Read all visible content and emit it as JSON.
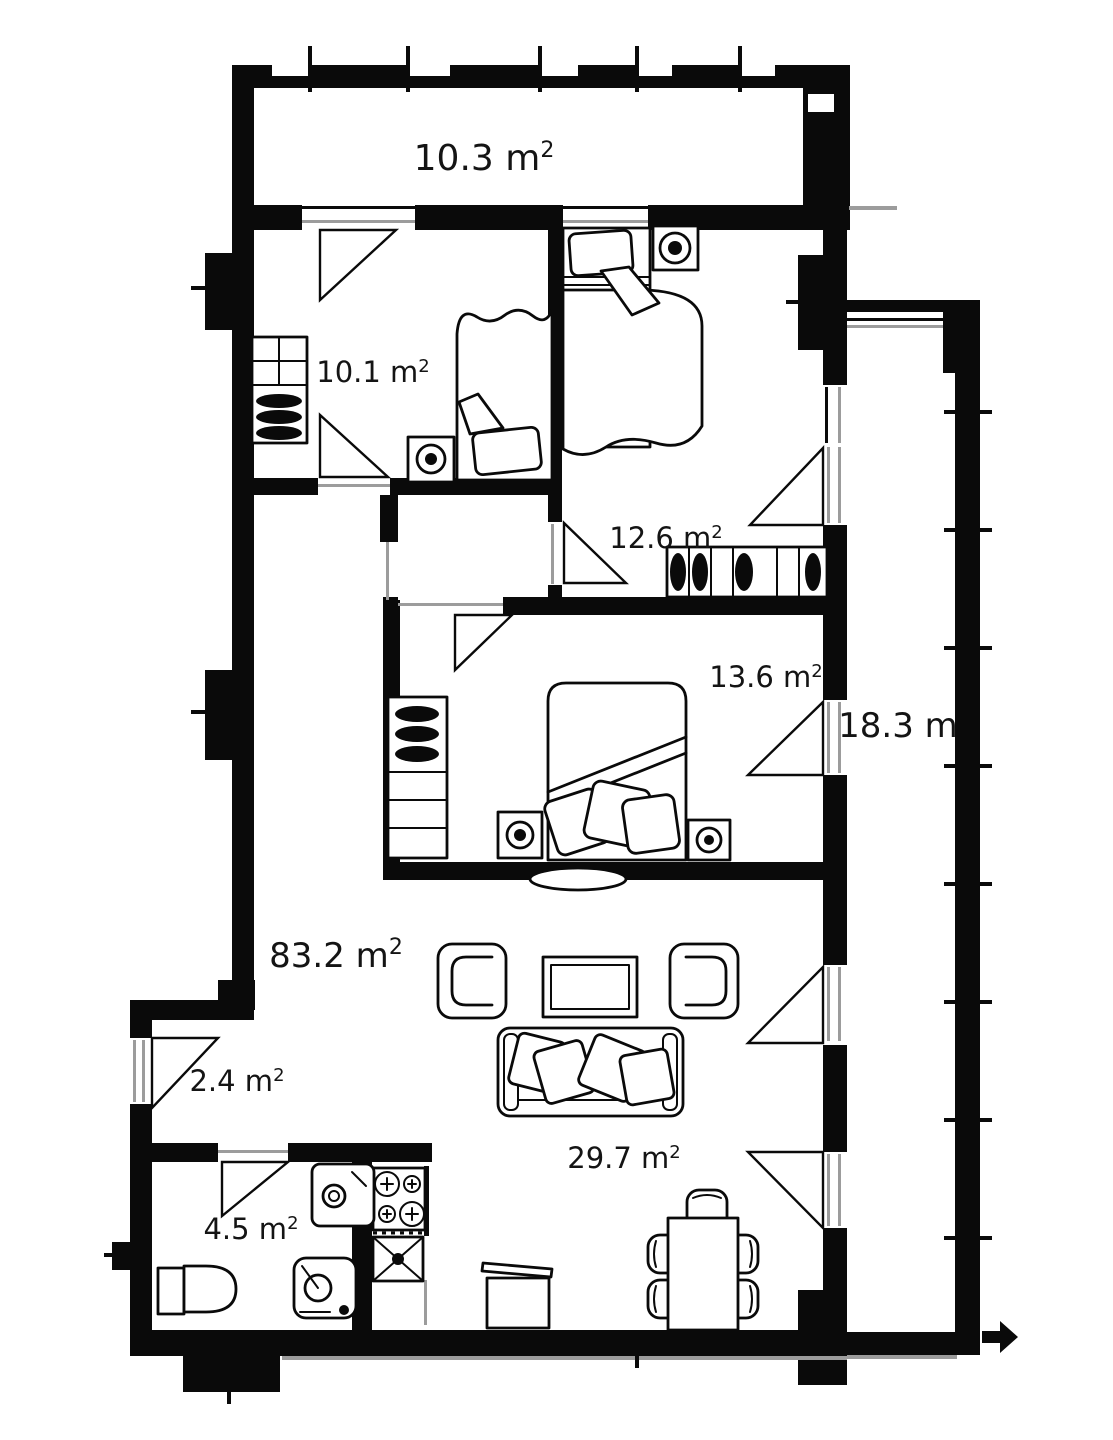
{
  "colors": {
    "ink": "#0a0a0a",
    "paper": "#ffffff",
    "sill_gray": "#9c9c9c",
    "label": "#141414"
  },
  "rooms": {
    "loggia_top": {
      "label": "10.3 m",
      "sup": "2"
    },
    "bedroom_small": {
      "label": "10.1 m",
      "sup": "2"
    },
    "bedroom_mid": {
      "label": "12.6 m",
      "sup": "2"
    },
    "bedroom_large": {
      "label": "13.6 m",
      "sup": "2"
    },
    "balcony_right": {
      "label": "18.3 m",
      "sup": ""
    },
    "total_area": {
      "label": "83.2 m",
      "sup": "2"
    },
    "entry_hall": {
      "label": "2.4 m",
      "sup": "2"
    },
    "bathroom": {
      "label": "4.5 m",
      "sup": "2"
    },
    "living_room": {
      "label": "29.7 m",
      "sup": "2"
    }
  },
  "furniture_symbols": [
    "double-bed",
    "single-bed",
    "wardrobe",
    "nightstand-lamp",
    "sofa",
    "pillow",
    "armchair",
    "coffee-table",
    "dining-table",
    "dining-chair",
    "stove",
    "kitchen-sink-cabinet",
    "trash-bin",
    "toilet",
    "washing-machine",
    "bathroom-sink",
    "radiator",
    "door-swing",
    "exit-arrow"
  ]
}
